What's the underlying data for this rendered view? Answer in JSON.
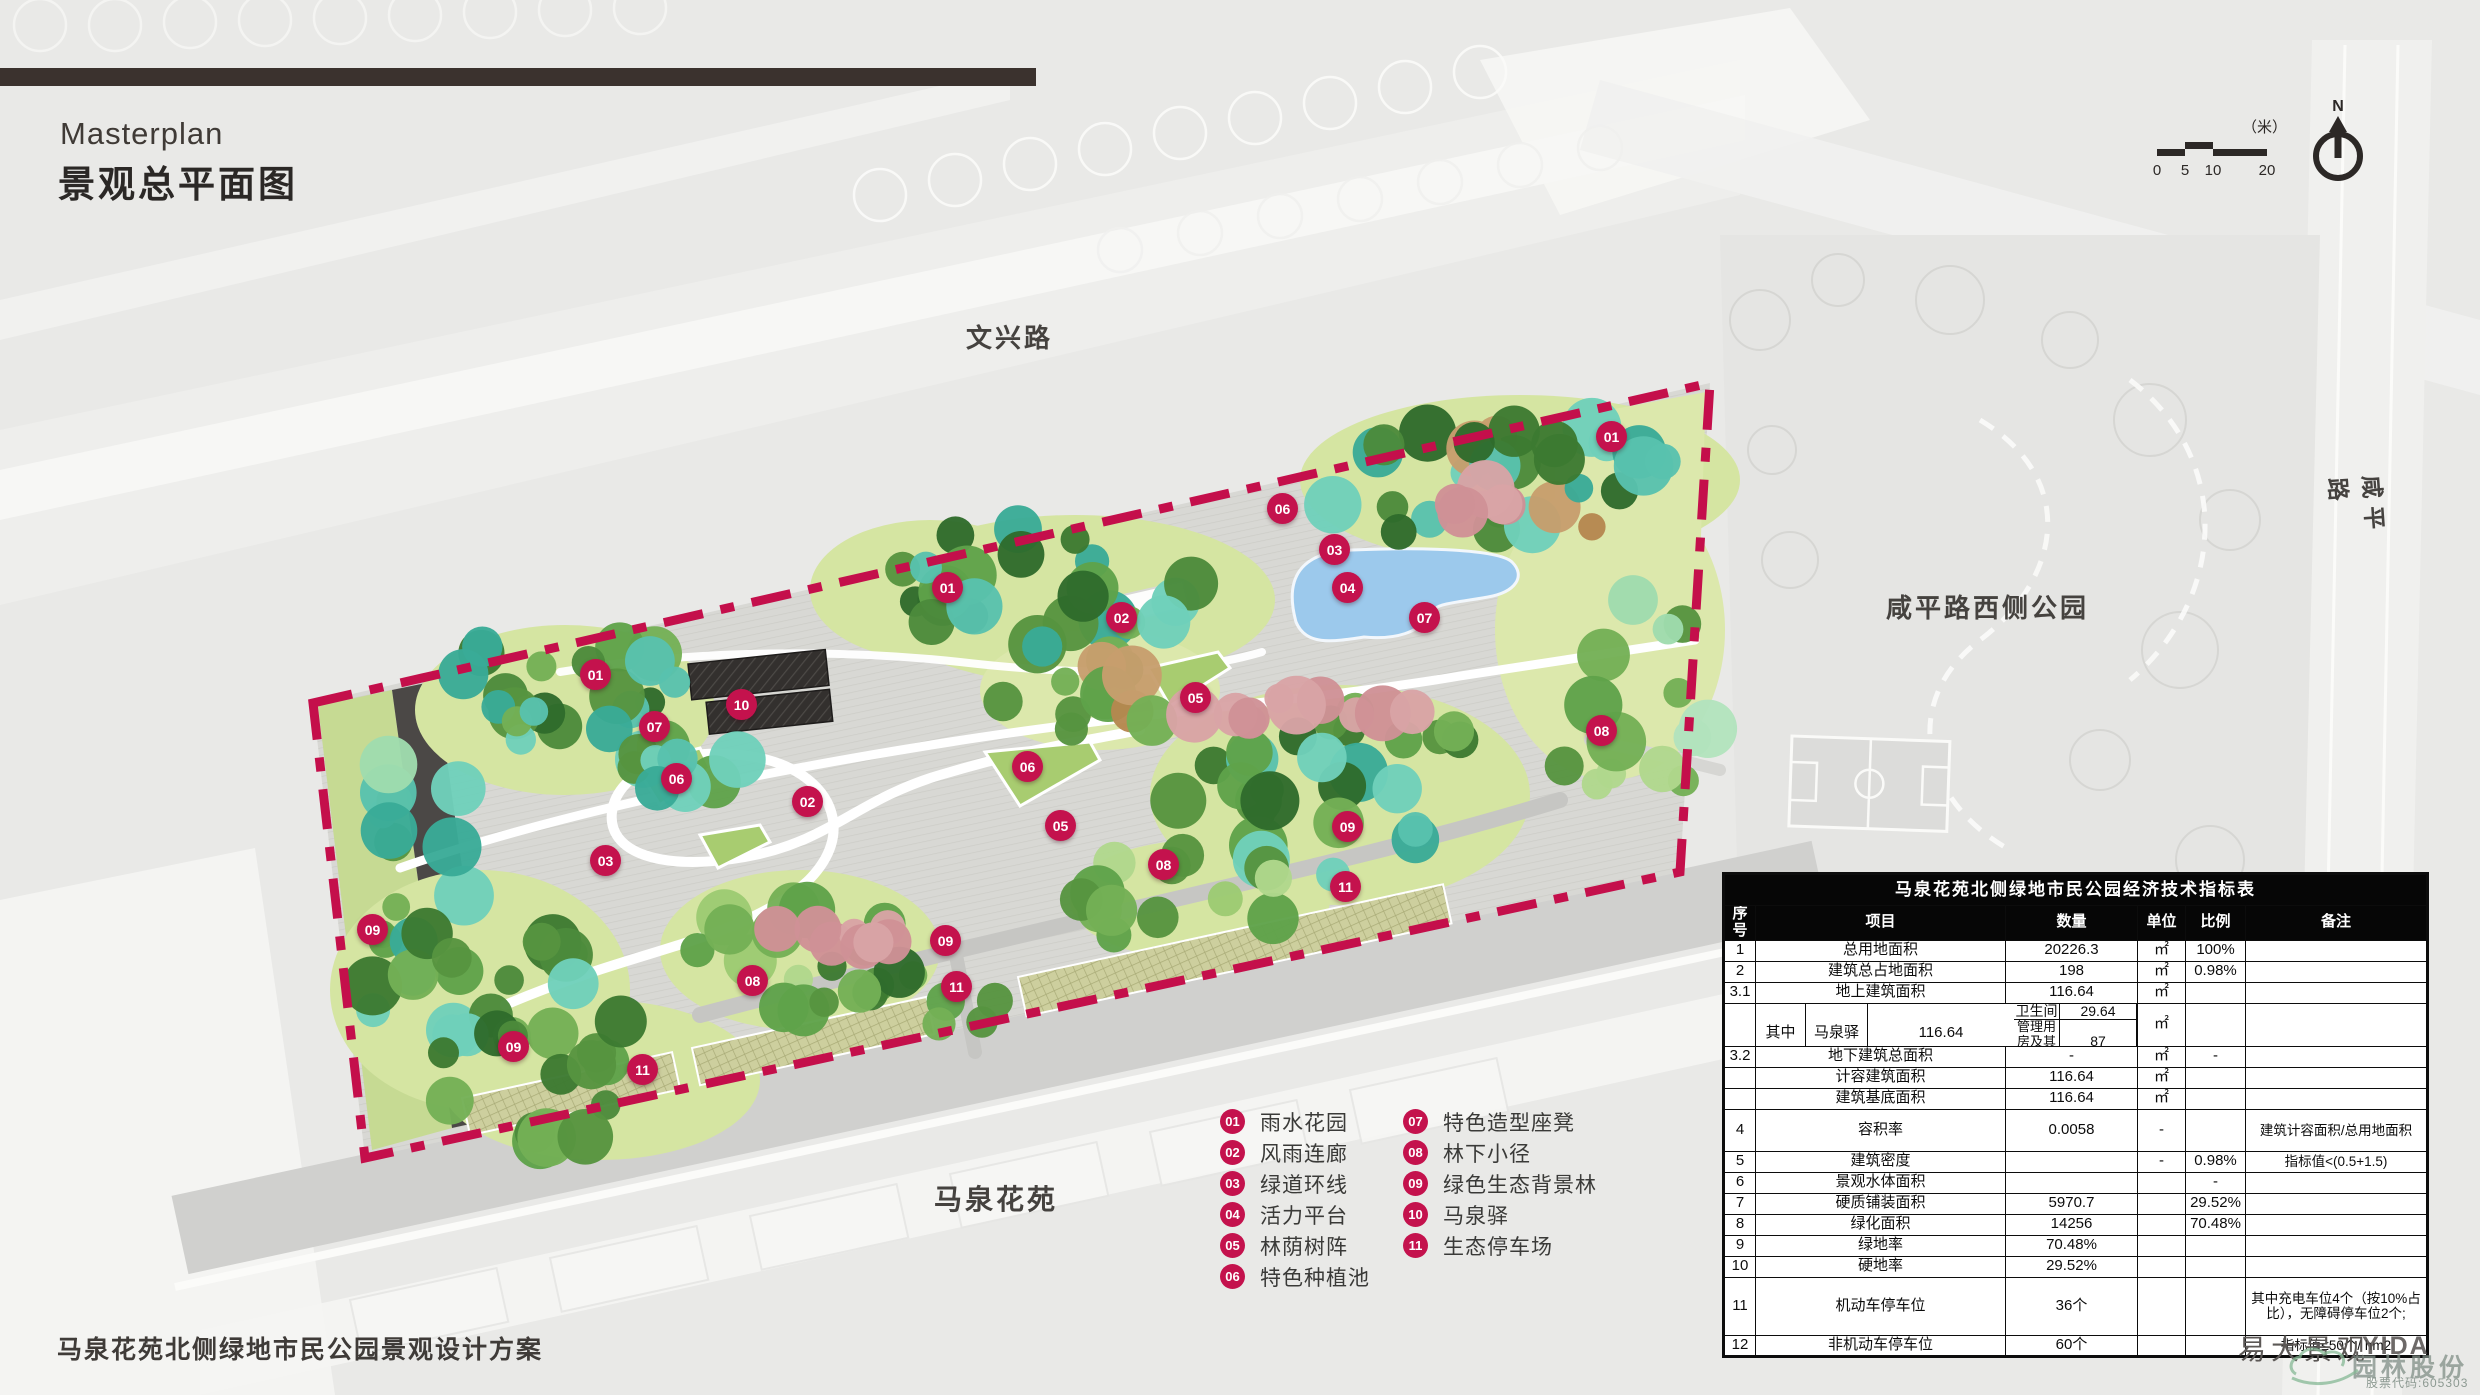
{
  "header": {
    "title_en": "Masterplan",
    "title_zh": "景观总平面图"
  },
  "map_labels": {
    "top_road": "文兴路",
    "right_road": "咸平路",
    "right_park": "咸平路西侧公园",
    "bottom_estate": "马泉花苑"
  },
  "compass": {
    "north_label": "N"
  },
  "scale_bar": {
    "unit": "（米）",
    "ticks": [
      "0",
      "5",
      "10",
      "20"
    ]
  },
  "legend": {
    "items": [
      {
        "num": "01",
        "label": "雨水花园"
      },
      {
        "num": "02",
        "label": "风雨连廊"
      },
      {
        "num": "03",
        "label": "绿道环线"
      },
      {
        "num": "04",
        "label": "活力平台"
      },
      {
        "num": "05",
        "label": "林荫树阵"
      },
      {
        "num": "06",
        "label": "特色种植池"
      },
      {
        "num": "07",
        "label": "特色造型座凳"
      },
      {
        "num": "08",
        "label": "林下小径"
      },
      {
        "num": "09",
        "label": "绿色生态背景林"
      },
      {
        "num": "10",
        "label": "马泉驿"
      },
      {
        "num": "11",
        "label": "生态停车场"
      }
    ]
  },
  "plan": {
    "markers": [
      {
        "num": "01",
        "x": 1612,
        "y": 437
      },
      {
        "num": "06",
        "x": 1283,
        "y": 509
      },
      {
        "num": "03",
        "x": 1335,
        "y": 550
      },
      {
        "num": "04",
        "x": 1348,
        "y": 588
      },
      {
        "num": "07",
        "x": 1425,
        "y": 618
      },
      {
        "num": "01",
        "x": 948,
        "y": 588
      },
      {
        "num": "02",
        "x": 1122,
        "y": 618
      },
      {
        "num": "05",
        "x": 1196,
        "y": 698
      },
      {
        "num": "01",
        "x": 596,
        "y": 675
      },
      {
        "num": "07",
        "x": 655,
        "y": 727
      },
      {
        "num": "10",
        "x": 742,
        "y": 705
      },
      {
        "num": "06",
        "x": 677,
        "y": 779
      },
      {
        "num": "06",
        "x": 1028,
        "y": 767
      },
      {
        "num": "08",
        "x": 1602,
        "y": 731
      },
      {
        "num": "02",
        "x": 808,
        "y": 802
      },
      {
        "num": "05",
        "x": 1061,
        "y": 826
      },
      {
        "num": "03",
        "x": 606,
        "y": 861
      },
      {
        "num": "08",
        "x": 1164,
        "y": 865
      },
      {
        "num": "09",
        "x": 1348,
        "y": 827
      },
      {
        "num": "11",
        "x": 1346,
        "y": 887
      },
      {
        "num": "09",
        "x": 373,
        "y": 930
      },
      {
        "num": "09",
        "x": 946,
        "y": 941
      },
      {
        "num": "08",
        "x": 753,
        "y": 981
      },
      {
        "num": "11",
        "x": 957,
        "y": 987
      },
      {
        "num": "09",
        "x": 514,
        "y": 1047
      },
      {
        "num": "11",
        "x": 643,
        "y": 1070
      }
    ]
  },
  "table": {
    "title": "马泉花苑北侧绿地市民公园经济技术指标表",
    "headers": [
      "序号",
      "项目",
      "数量",
      "单位",
      "比例",
      "备注"
    ],
    "rows": [
      {
        "no": "1",
        "item": "总用地面积",
        "qty": "20226.3",
        "unit": "㎡",
        "ratio": "100%",
        "note": ""
      },
      {
        "no": "2",
        "item": "建筑总占地面积",
        "qty": "198",
        "unit": "㎡",
        "ratio": "0.98%",
        "note": ""
      },
      {
        "no": "3.1",
        "item": "地上建筑面积",
        "qty": "116.64",
        "unit": "㎡",
        "ratio": "",
        "note": ""
      }
    ],
    "sub_row": {
      "no": "",
      "qualifier": "其中",
      "group": "马泉驿",
      "item1": "卫生间",
      "qty1": "29.64",
      "item2": "管理用房及其他",
      "qty2": "87",
      "total": "116.64",
      "unit": "㎡",
      "ratio": "",
      "note": ""
    },
    "rows2": [
      {
        "no": "3.2",
        "item": "地下建筑总面积",
        "qty": "-",
        "unit": "㎡",
        "ratio": "-",
        "note": ""
      },
      {
        "no": "",
        "item": "计容建筑面积",
        "qty": "116.64",
        "unit": "㎡",
        "ratio": "",
        "note": ""
      },
      {
        "no": "",
        "item": "建筑基底面积",
        "qty": "116.64",
        "unit": "㎡",
        "ratio": "",
        "note": ""
      },
      {
        "no": "4",
        "item": "容积率",
        "qty": "0.0058",
        "unit": "-",
        "ratio": "",
        "note": "建筑计容面积/总用地面积"
      },
      {
        "no": "5",
        "item": "建筑密度",
        "qty": "",
        "unit": "-",
        "ratio": "0.98%",
        "note": "指标值<(0.5+1.5)"
      },
      {
        "no": "6",
        "item": "景观水体面积",
        "qty": "",
        "unit": "",
        "ratio": "-",
        "note": ""
      },
      {
        "no": "7",
        "item": "硬质铺装面积",
        "qty": "5970.7",
        "unit": "",
        "ratio": "29.52%",
        "note": ""
      },
      {
        "no": "8",
        "item": "绿化面积",
        "qty": "14256",
        "unit": "",
        "ratio": "70.48%",
        "note": ""
      },
      {
        "no": "9",
        "item": "绿地率",
        "qty": "70.48%",
        "unit": "",
        "ratio": "",
        "note": ""
      },
      {
        "no": "10",
        "item": "硬地率",
        "qty": "29.52%",
        "unit": "",
        "ratio": "",
        "note": ""
      },
      {
        "no": "11",
        "item": "机动车停车位",
        "qty": "36个",
        "unit": "",
        "ratio": "",
        "note": "其中充电车位4个（按10%占比），无障碍停车位2个;"
      },
      {
        "no": "12",
        "item": "非机动车停车位",
        "qty": "60个",
        "unit": "",
        "ratio": "",
        "note": "指标值≤50个/ hm2"
      }
    ]
  },
  "footer": {
    "project": "马泉花苑北侧绿地市民公园景观设计方案",
    "studio": "易大景观",
    "logo_en": "YIDA",
    "watermark_company": "园林股份",
    "watermark_code": "股票代码:605303"
  },
  "colors": {
    "accent": "#c4124d",
    "boundary": "#c40f4b",
    "pond": "#9cc9ec",
    "parking": "#cdcf9e",
    "dark_road": "#4b4846",
    "header_bar": "#3b322e"
  }
}
